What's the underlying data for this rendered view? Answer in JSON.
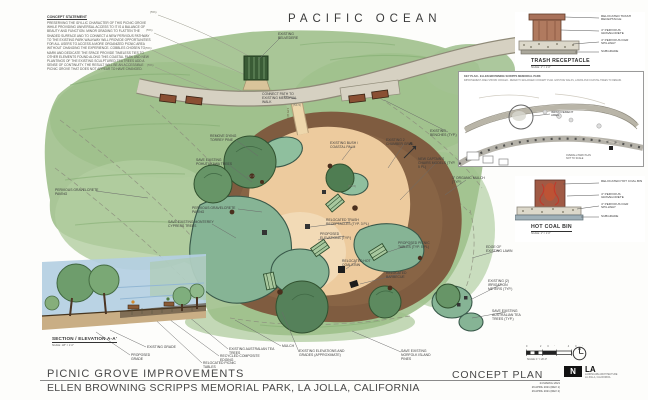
{
  "colors": {
    "paper": "#fdfdfb",
    "vegetation_green": "#a9c697",
    "shrub_teal": "#86b495",
    "canopy_green": "#5d8a5f",
    "mulch_brown": "#7f5c40",
    "plaza_tan": "#edcb9e",
    "road_gray": "#d6d1c2",
    "section_sky_blue": "#b4cfe2",
    "ink": "#3b3b3b"
  },
  "plan": {
    "ocean_label": "PACIFIC OCEAN",
    "callouts": [
      {
        "text": "EXISTING BELVEDERE"
      },
      {
        "text": "CONNECT PATH TO EXISTING MEMORIAL WALK"
      },
      {
        "text": "175 LF±"
      },
      {
        "text": "REMOVE DYING TORREY PINE"
      },
      {
        "text": "SAVE EXISTING POHUTUKAWA TREES"
      },
      {
        "text": "PERVIOUS GRAVELCRETE PAVING"
      },
      {
        "text": "PERVIOUS GRAVELCRETE PAVING"
      },
      {
        "text": "SAVE EXISTING MONTEREY CYPRESS TREES"
      },
      {
        "text": "EXISTING BUSH / COASTAL PALM"
      },
      {
        "text": "EXISTING 2 CHAMBER GRILL"
      },
      {
        "text": "EXISTING BENCHES (TYP.)"
      },
      {
        "text": "NEW CAPTAIN'S CHAIRS MODELS (TYP. 5 PL)"
      },
      {
        "text": "3\" ORGANIC MULCH (TYP.)"
      },
      {
        "text": "EDGE OF EXISTING LAWN"
      },
      {
        "text": "RELOCATED TRASH RECEPTACLES (TYP. 3 PL)"
      },
      {
        "text": "PROPOSED ELEVATIONS (TYP.)"
      },
      {
        "text": "RELOCATED HOT COALS BIN"
      },
      {
        "text": "RELOCATED BARBECUE"
      },
      {
        "text": "PROPOSED PICNIC TABLES (TYP. 5 PL)"
      },
      {
        "text": "EXISTING (2) IRRIGATION METERS (TYP.)"
      },
      {
        "text": "SAVE EXISTING AUSTRALIAN TEA TREES (TYP.)"
      },
      {
        "text": "(5%)"
      },
      {
        "text": "(5%)"
      },
      {
        "text": "(5%)"
      },
      {
        "text": "(5%)"
      },
      {
        "text": "(54.5)"
      },
      {
        "text": "(52.4)"
      },
      {
        "text": "(53.6)"
      },
      {
        "text": "A"
      }
    ]
  },
  "bottom_callouts": [
    {
      "text": "EXISTING GRADE"
    },
    {
      "text": "PROPOSED GRADE"
    },
    {
      "text": "RELOCATED PICNIC TABLES"
    },
    {
      "text": "RECYCLED COMPOSITE EDGING"
    },
    {
      "text": "EXISTING AUSTRALIAN TEA TREES"
    },
    {
      "text": "MULCH"
    },
    {
      "text": "EXISTING ELEVATIONS AND GRADES (APPROXIMATE)"
    },
    {
      "text": "SAVE EXISTING NORFOLK ISLAND PINES"
    }
  ],
  "concept_statement": {
    "heading": "CONCEPT STATEMENT",
    "body": "PRESERVING THE IDYLLIC CHARACTER OF THIS PICNIC GROVE WHILE PROVIDING UNIVERSAL ACCESS TO IT IS A BALANCE OF BEAUTY AND FUNCTION. MINOR GRADING TO FLATTEN THE SHADED SURFACE AND TO CONNECT A NEW PERVIOUS PATHWAY TO THE EXISTING PARK WALKWAY WILL PROVIDE OPPORTUNITIES FOR ALL USERS TO ACCESS A MORE ORGANIZED PICNIC AREA WITHOUT CHANGING THE EXPERIENCE. COBBLES CHOSEN TO MARK AND DEDICATE THE SPACE PROVIDE TIMELESS TIES TO OTHER ELEMENTS FOUND ALONG THIS COASTAL PARK AND NEW PLANTINGS OF THE EXISTING SCULPTURED TEA TREES ADD A SENSE OF CONTINUITY. THE RESULT WILL BE AN ACCESSIBLE PICNIC GROVE THAT DOES NOT APPEAR TO HAVE CHANGED."
  },
  "section": {
    "title": "SECTION / ELEVATION A-A'",
    "scale": "SCALE: 1/8\" = 1'-0\""
  },
  "details": {
    "trash": {
      "title": "TRASH RECEPTACLE",
      "scale": "SCALE: 1\" = 1'-0\"",
      "callouts": [
        "RELOCATED TRASH RECEPTACLE",
        "4\" PERVIOUS GRAVELCRETE",
        "4\" PERVIOUS DGR SPILLWAY",
        "SUBGRADE"
      ]
    },
    "hot_coal": {
      "title": "HOT COAL BIN",
      "scale": "SCALE: 1\" = 1'-0\"",
      "callouts": [
        "RELOCATED HOT COAL BIN",
        "4\" PERVIOUS GRAVELCRETE",
        "4\" PERVIOUS DGR SPILLWAY",
        "SUBGRADE"
      ]
    },
    "key_map": {
      "heading": "KEY PLAN - ELLEN BROWNING SCRIPPS MEMORIAL PARK",
      "note": "IMPROVEMENT AREA SHOWN CIRCLED - REFER TO ENLARGED CONCEPT PLAN. EXISTING WALKS, LAWNS AND COASTAL TREES TO REMAIN.",
      "area_label": "IMPROVEMENT AREA",
      "caption_line1": "OVERALL PARK PLAN",
      "caption_line2": "NOT TO SCALE"
    }
  },
  "titleblock": {
    "title": "PICNIC GROVE  IMPROVEMENTS",
    "subtitle": "ELLEN BROWNING SCRIPPS MEMORIAL PARK, LA JOLLA, CALIFORNIA",
    "plan_label": "CONCEPT PLAN",
    "scale_ticks": "0 20' 40'",
    "scale_note": "SCALE: 1\" = 20'-0\"",
    "dates": [
      "24 MARCH 2021",
      "26 APRIL 2021 (REV 1)",
      "29 APRIL 2021 (REV 2)"
    ],
    "logo": {
      "n": "N",
      "la": "LA",
      "firm_line1": "LANDSCAPE ARCHITECTURE",
      "firm_line2": "LA JOLLA, CALIFORNIA"
    }
  }
}
